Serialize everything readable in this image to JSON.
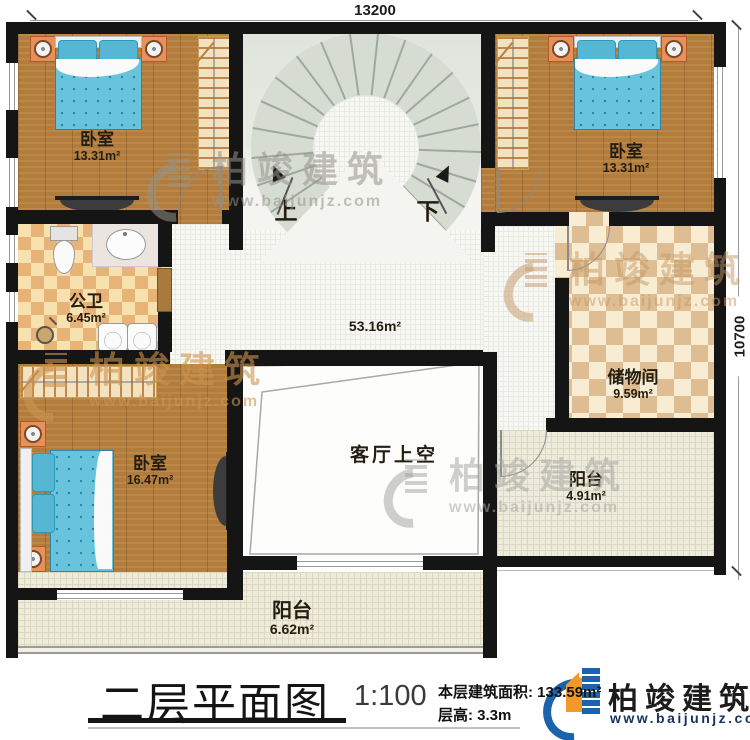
{
  "dimensions": {
    "top": "13200",
    "right": "10700"
  },
  "stairs": {
    "up": "上",
    "down": "下"
  },
  "rooms": {
    "bedroom_tl": {
      "name": "卧室",
      "area": "13.31m²"
    },
    "bedroom_tr": {
      "name": "卧室",
      "area": "13.31m²"
    },
    "bathroom": {
      "name": "公卫",
      "area": "6.45m²"
    },
    "hall": {
      "area": "53.16m²"
    },
    "storage": {
      "name": "储物间",
      "area": "9.59m²"
    },
    "bedroom_bl": {
      "name": "卧室",
      "area": "16.47m²"
    },
    "void": {
      "name": "客厅上空"
    },
    "balcony_right": {
      "name": "阳台",
      "area": "4.91m²"
    },
    "balcony_bottom": {
      "name": "阳台",
      "area": "6.62m²"
    }
  },
  "watermark": {
    "brand": "柏竣建筑",
    "url": "www.baijunjz.com"
  },
  "title_block": {
    "title": "二层平面图",
    "scale": "1:100",
    "area_label": "本层建筑面积: ",
    "area_value": "133.59m²",
    "floor_height_label": "层高: ",
    "floor_height_value": "3.3m",
    "brand": "柏竣建筑",
    "brand_url": "www.baijunjz.com"
  },
  "colors": {
    "wall": "#151515",
    "wood_floor": "#b27c3c",
    "stair": "#d6dcd2",
    "hall_tile": "#f7f7f3",
    "balcony_tile": "#edebdb",
    "bath_checker_dark": "#e7b377",
    "bath_checker_light": "#f7e1ae",
    "bed_blue": "#68c3dc",
    "logo_blue": "#1a63ad",
    "logo_orange": "#f2992c",
    "logo_url_navy": "#15325f"
  }
}
